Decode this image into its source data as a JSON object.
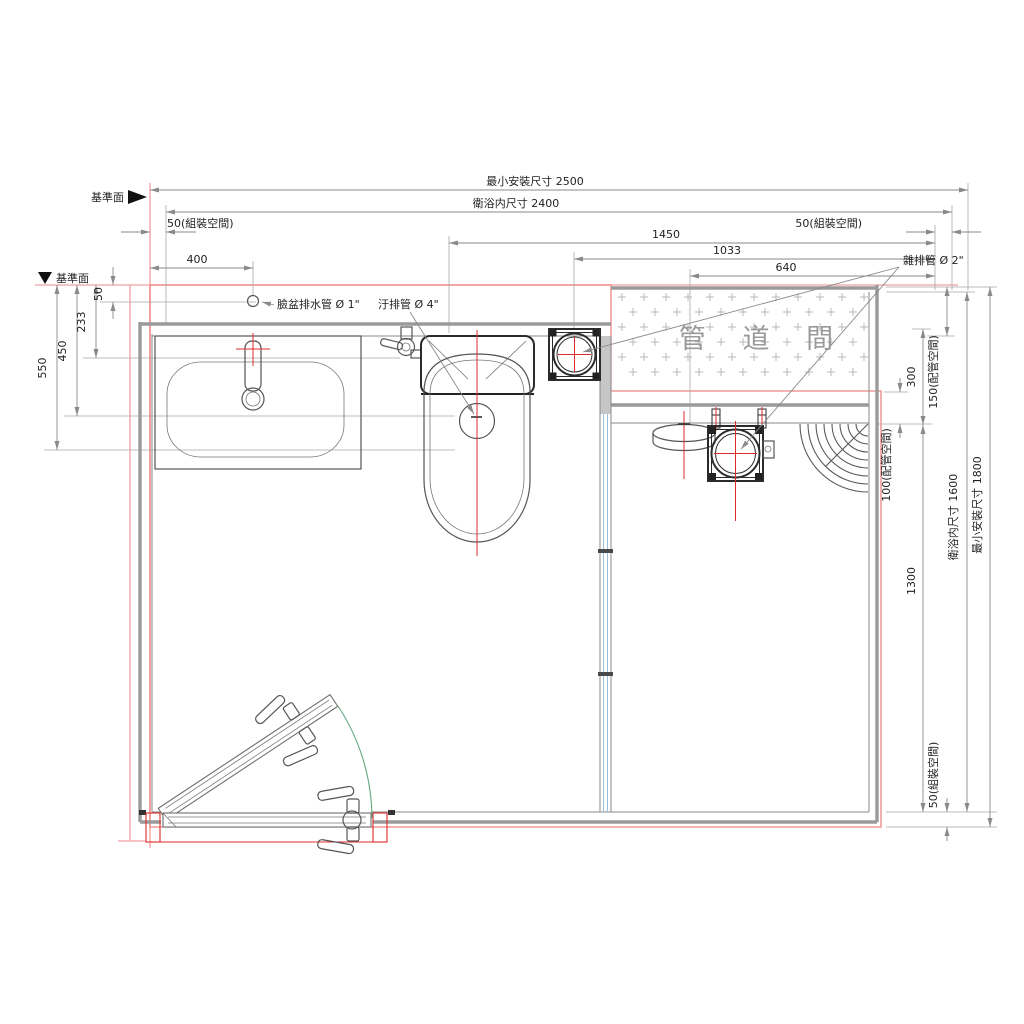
{
  "drawing": {
    "datum_label_top": "基準面",
    "datum_label_left": "基準面",
    "pipe_duct_label": "管 道 間",
    "leaders": {
      "basin_drain": "臉盆排水管 Ø 1\"",
      "soil_pipe": "汙排管 Ø 4\"",
      "misc_drain": "雜排管 Ø 2\""
    },
    "dims": {
      "top": {
        "min_install_width": "最小安裝尺寸 2500",
        "interior_width": "衛浴内尺寸 2400",
        "assembly_left": "50(組裝空間)",
        "assembly_right": "50(組裝空間)",
        "d1450": "1450",
        "d1033": "1033",
        "d640": "640",
        "d400": "400"
      },
      "left": {
        "d50": "50",
        "d233": "233",
        "d450": "450",
        "d550": "550"
      },
      "right": {
        "d300": "300",
        "pipe_space_150": "150(配管空間)",
        "pipe_space_100": "100(配管空間)",
        "d1300": "1300",
        "interior_height": "衛浴内尺寸 1600",
        "min_install_height": "最小安裝尺寸 1800",
        "assembly_bottom": "50(組裝空間)"
      }
    },
    "colors": {
      "datum_line": "#f3b0b0",
      "boundary_line": "#ee8585",
      "centerline": "#dd2b2b",
      "wall": "#9a9a9a",
      "dim_line": "#8a8a8a",
      "text": "#1f1f1f",
      "hatch": "#b9b9b9",
      "duct_text": "#9a9a9a",
      "door_swing": "#63a882",
      "glass": "#92b8d8"
    }
  }
}
